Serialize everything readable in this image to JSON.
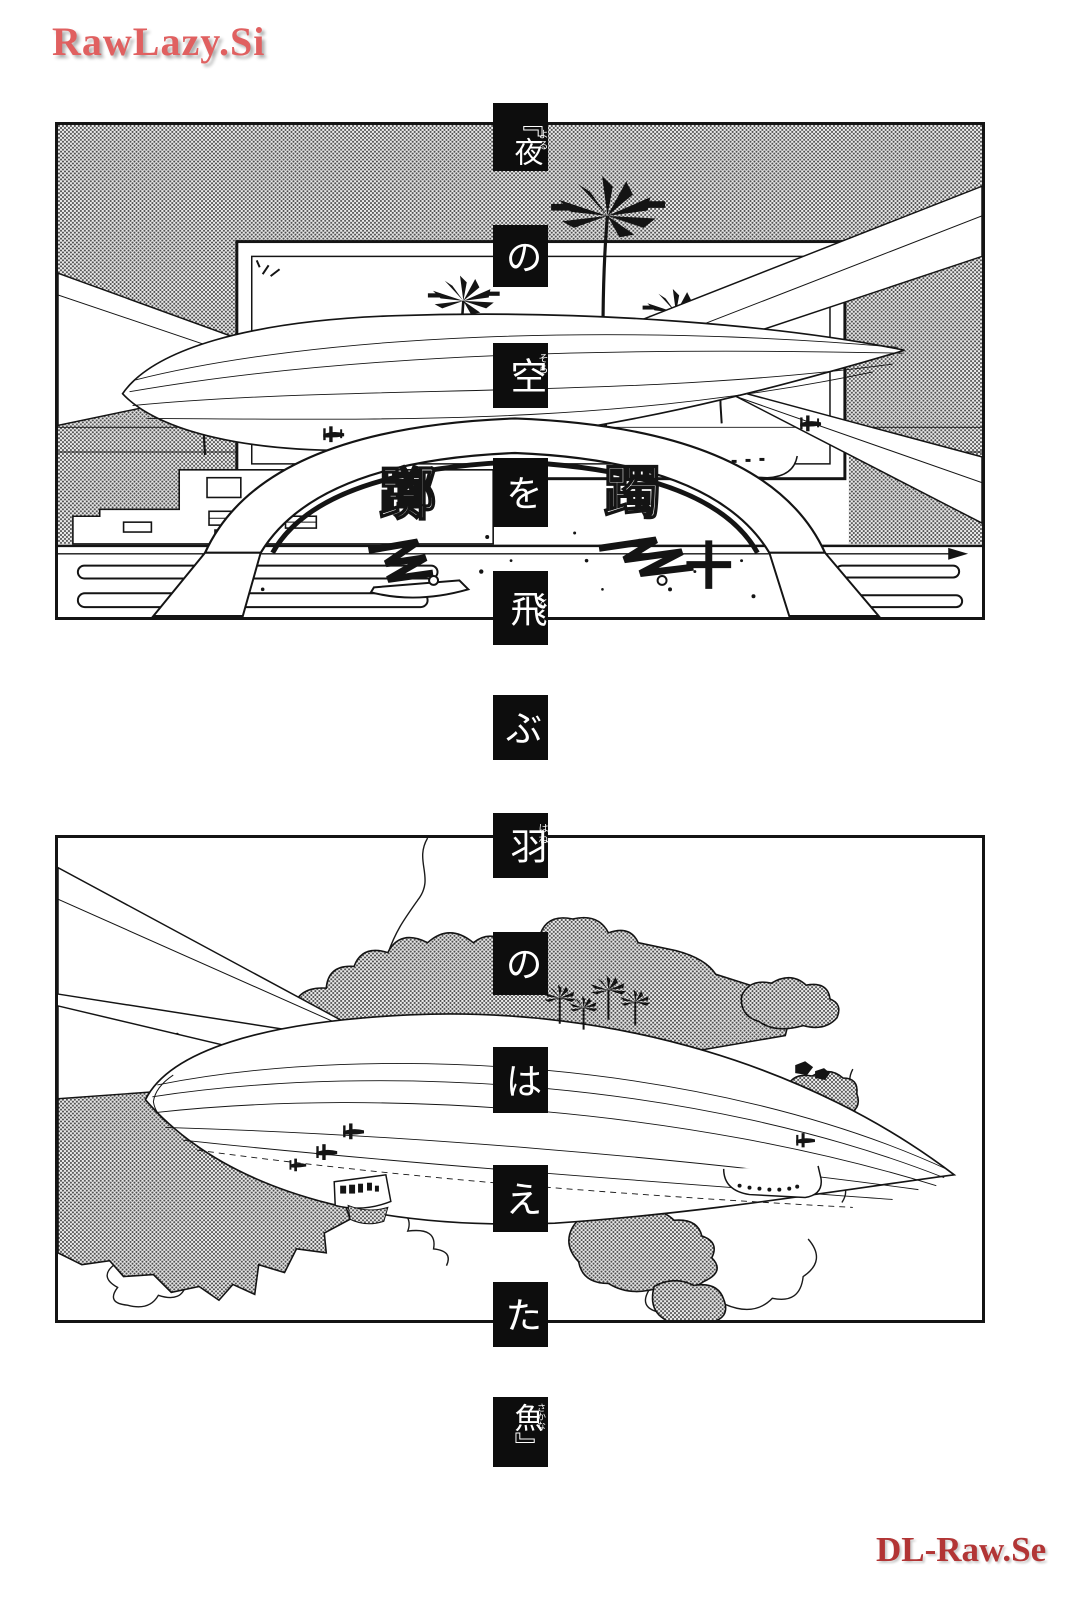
{
  "page": {
    "watermark_top": "RawLazy.Si",
    "watermark_bottom": "DL-Raw.Se"
  },
  "colors": {
    "watermark_top_text": "#e06060",
    "watermark_bottom_text": "#b23535",
    "panel_border": "#141414",
    "title_box_background": "#0d0d0d",
    "title_box_text": "#ffffff",
    "screentone_gray": "#9a9a9a",
    "ink": "#141414",
    "page_background": "#ffffff"
  },
  "title_vertical": {
    "full_text": "『夜の空を飛ぶ羽のはえた魚』",
    "boxes": [
      {
        "text": "『夜",
        "furigana": "よる"
      },
      {
        "text": "の",
        "furigana": ""
      },
      {
        "text": "空",
        "furigana": "そら"
      },
      {
        "text": "を",
        "furigana": ""
      },
      {
        "text": "飛",
        "furigana": "と"
      },
      {
        "text": "ぶ",
        "furigana": ""
      },
      {
        "text": "羽",
        "furigana": "はね"
      },
      {
        "text": "の",
        "furigana": ""
      },
      {
        "text": "は",
        "furigana": ""
      },
      {
        "text": "え",
        "furigana": ""
      },
      {
        "text": "た",
        "furigana": ""
      },
      {
        "text": "魚』",
        "furigana": "さかな"
      }
    ]
  },
  "panel1": {
    "arch_left_kanji": "躑",
    "arch_right_kanji": "躅"
  }
}
